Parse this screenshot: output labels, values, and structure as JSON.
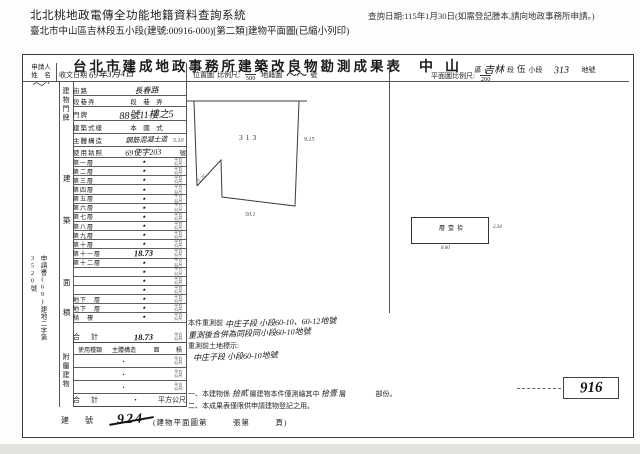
{
  "header": {
    "system_title": "北北桃地政電傳全功能地籍資料查詢系統",
    "query_date": "查詢日期:115年1月30日(如需登記謄本,請向地政事務所申請。)",
    "doc_line": "臺北市中山區吉林段五小段(建號:00916-000)[第二類]建物平面圖(已縮小列印)"
  },
  "form": {
    "title": "台北市建成地政事務所建築改良物勘測成果表",
    "locality": {
      "district": "中山",
      "district_unit": "區",
      "section": "吉林",
      "section_unit": "段",
      "subsection": "伍",
      "subsection_unit": "小段",
      "parcel": "313",
      "parcel_unit": "地號"
    },
    "applicant_label_1": "申請人",
    "applicant_label_2": "姓　名",
    "receipt": {
      "label": "收文日期",
      "value": "69年3月4日"
    },
    "location_scale": {
      "label": "位置圖",
      "scale_label": "比例尺:",
      "num": "1",
      "den": "500",
      "map_label": "地籍圖",
      "no_label": "號"
    },
    "plan_scale": {
      "label": "平面圖比例尺:",
      "num": "1",
      "den": "200"
    },
    "address": {
      "strip": "建物門牌",
      "street_label": "街路",
      "street_value": "長春路",
      "lane_label": "段巷弄",
      "lane_value": "段　巷　弄",
      "door_label": "門牌",
      "door_value": "88號11樓之5",
      "style_label": "建築式樣",
      "style_value": "本　國　式",
      "structure_label": "主體構造",
      "structure_value": "鋼筋混凝土造",
      "license_label": "使用執照",
      "license_value": "69使字203",
      "license_unit": "號"
    },
    "area_strip": [
      "建",
      "築",
      "面",
      "積"
    ],
    "unit": "平方公尺",
    "floors": [
      {
        "label": "第一層",
        "value": "・"
      },
      {
        "label": "第二層",
        "value": "・"
      },
      {
        "label": "第三層",
        "value": "・"
      },
      {
        "label": "第四層",
        "value": "・"
      },
      {
        "label": "第五層",
        "value": "・"
      },
      {
        "label": "第六層",
        "value": "・"
      },
      {
        "label": "第七層",
        "value": "・"
      },
      {
        "label": "第八層",
        "value": "・"
      },
      {
        "label": "第九層",
        "value": "・"
      },
      {
        "label": "第十層",
        "value": "・"
      },
      {
        "label": "第十一層",
        "value": "18.73"
      },
      {
        "label": "第十二層",
        "value": "・"
      },
      {
        "label": "",
        "value": "・"
      },
      {
        "label": "",
        "value": "・"
      },
      {
        "label": "",
        "value": "・"
      },
      {
        "label": "地下　層",
        "value": "・"
      },
      {
        "label": "地下　層",
        "value": "・"
      },
      {
        "label": "騎　樓",
        "value": "・"
      }
    ],
    "floors_total": {
      "label": "合　計",
      "value": "18.73"
    },
    "annex": {
      "strip": "附屬建物",
      "headers": [
        "使用種類",
        "主體構造",
        "面",
        "積"
      ],
      "rows": [
        {
          "value": "・"
        },
        {
          "value": "・"
        },
        {
          "value": "・"
        }
      ],
      "total_label": "合　計",
      "total_value": "・"
    },
    "app_no_vertical": "申請書(69)建地二字第3520號",
    "location_map_labels": {
      "parcel": "313",
      "left": "5.10",
      "right": "9.15",
      "bottom": "50.1",
      "diagonal": "5.25"
    },
    "plan": {
      "room_label": "拾壹層",
      "dim_right": "2.34",
      "dim_bottom": "8.00"
    },
    "notes": {
      "line1_printed": "本件重測前",
      "line1_hand": "中庄子段 小段60-10、60-12地號",
      "line2_hand": "重測後合併為同段同小段60-10地號",
      "line3_printed": "重測前土地標示:",
      "line4_hand": "中庄子段 小段60-10地號",
      "note1_prefix": "一、本建物係",
      "note1_hand1": "拾貳",
      "note1_mid": "層建物本件僅測繪其中",
      "note1_hand2": "拾壹",
      "note1_suffix": "層",
      "note1_tail": "部份。",
      "note2": "二、本成果表僅限供申請建物登記之用。"
    },
    "building_no": {
      "label": "建　號",
      "old_value": "924",
      "new_value": "916"
    },
    "footer": "(建物平面圖第　　　張第　　　頁)"
  }
}
